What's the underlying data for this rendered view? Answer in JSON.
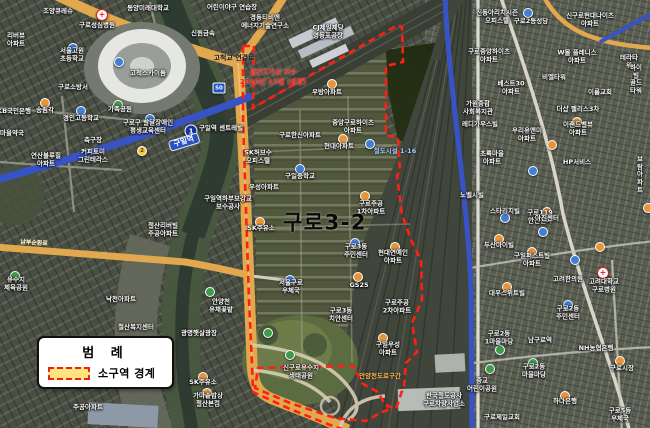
{
  "figure": {
    "district_label": "구로3-2"
  },
  "legend": {
    "title": "범 례",
    "items": [
      {
        "swatch": "yellow-fill-red-dashed",
        "label": "소구역 경계"
      }
    ]
  },
  "colors": {
    "boundary_red": "#ff2014",
    "legend_fill": "#ffe37e",
    "legend_border": "#e8231a",
    "road_orange": "#e2a84e",
    "rail_blue": "#3753c6",
    "river_dark": "#2e3b31"
  },
  "map": {
    "labels": [
      {
        "t": "구로3-2",
        "x": 325,
        "y": 223,
        "c": "xl",
        "n": "district-label"
      },
      {
        "t": "고척교 연결로",
        "x": 234,
        "y": 58,
        "c": "black",
        "n": "annotation-road-link"
      },
      {
        "t": "경인고가상 보수",
        "x": 273,
        "y": 72,
        "c": "red",
        "n": "annotation-notice-line1"
      },
      {
        "t": "2025년 10월 (예정)",
        "x": 273,
        "y": 82,
        "c": "red",
        "n": "annotation-notice-line2"
      },
      {
        "t": "구일역",
        "x": 184,
        "y": 142,
        "c": "station",
        "r": -17,
        "n": "station-label-guil"
      },
      {
        "t": "남부순환로",
        "x": 34,
        "y": 243,
        "c": "road",
        "r": 4,
        "n": "road-label"
      },
      {
        "t": "철도시설 1-16",
        "x": 395,
        "y": 152,
        "c": "blue"
      },
      {
        "t": "안양천도로구간",
        "x": 380,
        "y": 377,
        "c": "orange"
      },
      {
        "t": "조양큐레슈",
        "x": 58,
        "y": 12
      },
      {
        "t": "구로성심병원",
        "x": 97,
        "y": 26
      },
      {
        "t": "동양미래대학교",
        "x": 148,
        "y": 9
      },
      {
        "t": "어린이야구 연습장",
        "x": 232,
        "y": 8
      },
      {
        "t": "경동티비엔\n에너지기술연구소",
        "x": 265,
        "y": 22
      },
      {
        "t": "CJ제일제당\n영등포공장",
        "x": 328,
        "y": 32
      },
      {
        "t": "신원금속",
        "x": 203,
        "y": 34
      },
      {
        "t": "리버뷰\n아파트",
        "x": 16,
        "y": 40
      },
      {
        "t": "서울고원\n초등학교",
        "x": 72,
        "y": 55
      },
      {
        "t": "고척스카이돔",
        "x": 148,
        "y": 74
      },
      {
        "t": "구로소방서",
        "x": 73,
        "y": 88
      },
      {
        "t": "가족공원",
        "x": 120,
        "y": 110
      },
      {
        "t": "KB국민은행",
        "x": 14,
        "y": 112
      },
      {
        "t": "송림각",
        "x": 45,
        "y": 111
      },
      {
        "t": "경인고등학교",
        "x": 81,
        "y": 119
      },
      {
        "t": "마을약국",
        "x": 12,
        "y": 134
      },
      {
        "t": "구로구 발달장애인\n평생교육센터",
        "x": 148,
        "y": 127
      },
      {
        "t": "축구장",
        "x": 93,
        "y": 141
      },
      {
        "t": "연산블루힐\n아파트",
        "x": 46,
        "y": 160
      },
      {
        "t": "커피토미\n그린테라스",
        "x": 93,
        "y": 156
      },
      {
        "t": "구일역 센트레빌",
        "x": 221,
        "y": 129
      },
      {
        "t": "SK허브수\n오피스텔",
        "x": 258,
        "y": 157
      },
      {
        "t": "우성아파트",
        "x": 264,
        "y": 188
      },
      {
        "t": "구일역하부보강교\n보수공사",
        "x": 228,
        "y": 203
      },
      {
        "t": "철산리버빌\n주공아파트",
        "x": 163,
        "y": 230
      },
      {
        "t": "SK주유소",
        "x": 261,
        "y": 229
      },
      {
        "t": "유수지\n체육공원",
        "x": 16,
        "y": 284
      },
      {
        "t": "낙천아파트",
        "x": 121,
        "y": 300
      },
      {
        "t": "안양천\n유채꽃밭",
        "x": 221,
        "y": 306
      },
      {
        "t": "광명햇살광장",
        "x": 199,
        "y": 334
      },
      {
        "t": "철산복지센터",
        "x": 136,
        "y": 328
      },
      {
        "t": "SK주유소",
        "x": 203,
        "y": 383
      },
      {
        "t": "가마솥밥상\n철산본점",
        "x": 208,
        "y": 400
      },
      {
        "t": "주공아파트",
        "x": 88,
        "y": 408
      },
      {
        "t": "서울구로\n우체국",
        "x": 291,
        "y": 287
      },
      {
        "t": "신구로유수지\n생태공원",
        "x": 301,
        "y": 372
      },
      {
        "t": "구일중학교",
        "x": 300,
        "y": 177
      },
      {
        "t": "구로한신아파트",
        "x": 300,
        "y": 136
      },
      {
        "t": "현대아파트",
        "x": 339,
        "y": 147
      },
      {
        "t": "중앙구로하이츠\n아파트",
        "x": 353,
        "y": 127
      },
      {
        "t": "우방아파트",
        "x": 327,
        "y": 93
      },
      {
        "t": "구로주공\n1차아파트",
        "x": 371,
        "y": 208
      },
      {
        "t": "구로3동\n주민센터",
        "x": 356,
        "y": 251
      },
      {
        "t": "GS25",
        "x": 359,
        "y": 286
      },
      {
        "t": "구로3동\n치안센터",
        "x": 341,
        "y": 315
      },
      {
        "t": "구로주공\n2차아파트",
        "x": 397,
        "y": 307
      },
      {
        "t": "현대연예인\n아파트",
        "x": 393,
        "y": 257
      },
      {
        "t": "구일우성\n아파트",
        "x": 388,
        "y": 349
      },
      {
        "t": "한국철도공사\n구로차량사업소",
        "x": 444,
        "y": 400
      },
      {
        "t": "신동아리치시즌\n오피스텔",
        "x": 497,
        "y": 17
      },
      {
        "t": "구로2동성당",
        "x": 531,
        "y": 22
      },
      {
        "t": "신구로현대나이츠\n아파트",
        "x": 590,
        "y": 20
      },
      {
        "t": "구로중앙하이츠\n아파트",
        "x": 489,
        "y": 56
      },
      {
        "t": "W몰 플레니스\n아파트",
        "x": 577,
        "y": 57
      },
      {
        "t": "테라타워",
        "x": 629,
        "y": 62
      },
      {
        "t": "비엘타워",
        "x": 554,
        "y": 78
      },
      {
        "t": "하이빌\n골드타워",
        "x": 636,
        "y": 80
      },
      {
        "t": "베스트30\n아파트",
        "x": 511,
        "y": 88
      },
      {
        "t": "이룸교회",
        "x": 600,
        "y": 93
      },
      {
        "t": "더샵 팰리스3차",
        "x": 578,
        "y": 110
      },
      {
        "t": "가원종합\n사회복지관",
        "x": 478,
        "y": 108
      },
      {
        "t": "레디가우스빌",
        "x": 480,
        "y": 125
      },
      {
        "t": "우리유앤미\n아파트",
        "x": 527,
        "y": 135
      },
      {
        "t": "이랜드벨뷰\n아파트",
        "x": 578,
        "y": 129
      },
      {
        "t": "초록마을\n아파트",
        "x": 492,
        "y": 158
      },
      {
        "t": "HP서비스",
        "x": 577,
        "y": 163
      },
      {
        "t": "보람아파트",
        "x": 640,
        "y": 175
      },
      {
        "t": "노벨시빌",
        "x": 472,
        "y": 196
      },
      {
        "t": "스타리치빌",
        "x": 505,
        "y": 212
      },
      {
        "t": "구로119\n안전센터",
        "x": 540,
        "y": 217
      },
      {
        "t": "아진센터",
        "x": 547,
        "y": 219
      },
      {
        "t": "두산마이빌",
        "x": 499,
        "y": 246
      },
      {
        "t": "구일퍼스트빌\n아파트",
        "x": 532,
        "y": 260
      },
      {
        "t": "고려한의원",
        "x": 568,
        "y": 280
      },
      {
        "t": "고려대학교\n구로병원",
        "x": 604,
        "y": 286
      },
      {
        "t": "대우스위트빌",
        "x": 507,
        "y": 294
      },
      {
        "t": "구로2동\n주민센터",
        "x": 568,
        "y": 313
      },
      {
        "t": "구로2동\n1마을마당",
        "x": 499,
        "y": 338
      },
      {
        "t": "남구로역",
        "x": 540,
        "y": 341
      },
      {
        "t": "NH농협은행",
        "x": 596,
        "y": 349
      },
      {
        "t": "구로시장",
        "x": 622,
        "y": 369
      },
      {
        "t": "구로2동\n마을마당",
        "x": 534,
        "y": 371
      },
      {
        "t": "중교\n어린이공원",
        "x": 482,
        "y": 385
      },
      {
        "t": "하나은행",
        "x": 565,
        "y": 402
      },
      {
        "t": "구로5동\n우체국",
        "x": 620,
        "y": 415
      },
      {
        "t": "구로제일교회",
        "x": 502,
        "y": 418
      }
    ],
    "markers": [
      {
        "x": 102,
        "y": 15,
        "k": "rc"
      },
      {
        "x": 603,
        "y": 273,
        "k": "rc"
      },
      {
        "x": 191,
        "y": 131,
        "k": "b1",
        "g": "1"
      },
      {
        "x": 219,
        "y": 88,
        "k": "b50",
        "g": "50"
      },
      {
        "x": 142,
        "y": 151,
        "k": "by",
        "g": "2"
      },
      {
        "x": 45,
        "y": 103,
        "k": "o"
      },
      {
        "x": 260,
        "y": 222,
        "k": "o"
      },
      {
        "x": 203,
        "y": 377,
        "k": "o"
      },
      {
        "x": 207,
        "y": 393,
        "k": "o"
      },
      {
        "x": 358,
        "y": 277,
        "k": "o"
      },
      {
        "x": 383,
        "y": 338,
        "k": "o"
      },
      {
        "x": 395,
        "y": 247,
        "k": "o"
      },
      {
        "x": 365,
        "y": 196,
        "k": "o"
      },
      {
        "x": 343,
        "y": 139,
        "k": "o"
      },
      {
        "x": 332,
        "y": 84,
        "k": "o"
      },
      {
        "x": 499,
        "y": 239,
        "k": "o"
      },
      {
        "x": 577,
        "y": 122,
        "k": "o"
      },
      {
        "x": 552,
        "y": 145,
        "k": "o"
      },
      {
        "x": 600,
        "y": 247,
        "k": "o"
      },
      {
        "x": 648,
        "y": 208,
        "k": "o"
      },
      {
        "x": 620,
        "y": 361,
        "k": "o"
      },
      {
        "x": 565,
        "y": 396,
        "k": "o"
      },
      {
        "x": 532,
        "y": 252,
        "k": "o"
      },
      {
        "x": 507,
        "y": 287,
        "k": "o"
      },
      {
        "x": 547,
        "y": 212,
        "k": "o"
      },
      {
        "x": 119,
        "y": 62,
        "k": "b"
      },
      {
        "x": 73,
        "y": 48,
        "k": "b"
      },
      {
        "x": 81,
        "y": 111,
        "k": "b"
      },
      {
        "x": 150,
        "y": 119,
        "k": "b"
      },
      {
        "x": 300,
        "y": 169,
        "k": "b"
      },
      {
        "x": 370,
        "y": 144,
        "k": "b"
      },
      {
        "x": 533,
        "y": 171,
        "k": "b"
      },
      {
        "x": 543,
        "y": 232,
        "k": "b"
      },
      {
        "x": 568,
        "y": 305,
        "k": "b"
      },
      {
        "x": 528,
        "y": 13,
        "k": "b"
      },
      {
        "x": 575,
        "y": 260,
        "k": "b"
      },
      {
        "x": 505,
        "y": 218,
        "k": "b"
      },
      {
        "x": 355,
        "y": 243,
        "k": "b"
      },
      {
        "x": 290,
        "y": 280,
        "k": "b"
      },
      {
        "x": 210,
        "y": 292,
        "k": "g"
      },
      {
        "x": 290,
        "y": 355,
        "k": "g"
      },
      {
        "x": 490,
        "y": 369,
        "k": "g"
      },
      {
        "x": 500,
        "y": 350,
        "k": "g"
      },
      {
        "x": 533,
        "y": 363,
        "k": "g"
      },
      {
        "x": 15,
        "y": 276,
        "k": "g"
      },
      {
        "x": 118,
        "y": 105,
        "k": "g"
      },
      {
        "x": 268,
        "y": 333,
        "k": "g"
      }
    ]
  }
}
